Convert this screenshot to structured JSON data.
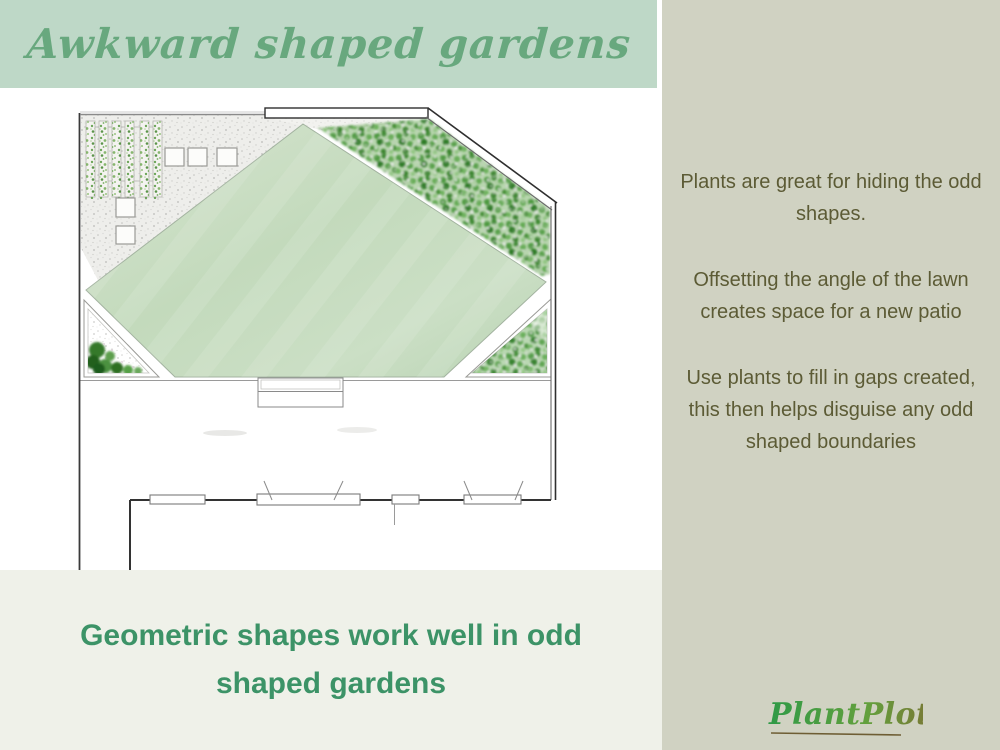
{
  "header": {
    "title": "Awkward shaped gardens",
    "bg_color": "#bed8c7",
    "text_color": "#68a87e"
  },
  "info_panel": {
    "bg_color": "#d0d2c2",
    "text_color": "#5c5b35",
    "paragraphs": [
      "Plants are great for hiding the odd shapes.",
      "Offsetting the angle of the lawn creates space for a new patio",
      "Use plants to fill in gaps created, this then helps disguise any odd shaped boundaries"
    ]
  },
  "caption": {
    "headline": "Geometric shapes work well in odd shaped gardens",
    "bg_color": "#eff1e9",
    "text_color": "#3c9367"
  },
  "brand": {
    "logo_text": "PlantPlots",
    "gradient_start": "#2e9a47",
    "gradient_end": "#7f6e33"
  },
  "plan": {
    "kind": "hand-drawn garden design plan",
    "lawn_color": "#c3dabc",
    "foliage_color": "#4a9140",
    "gravel_color": "#ededea"
  }
}
